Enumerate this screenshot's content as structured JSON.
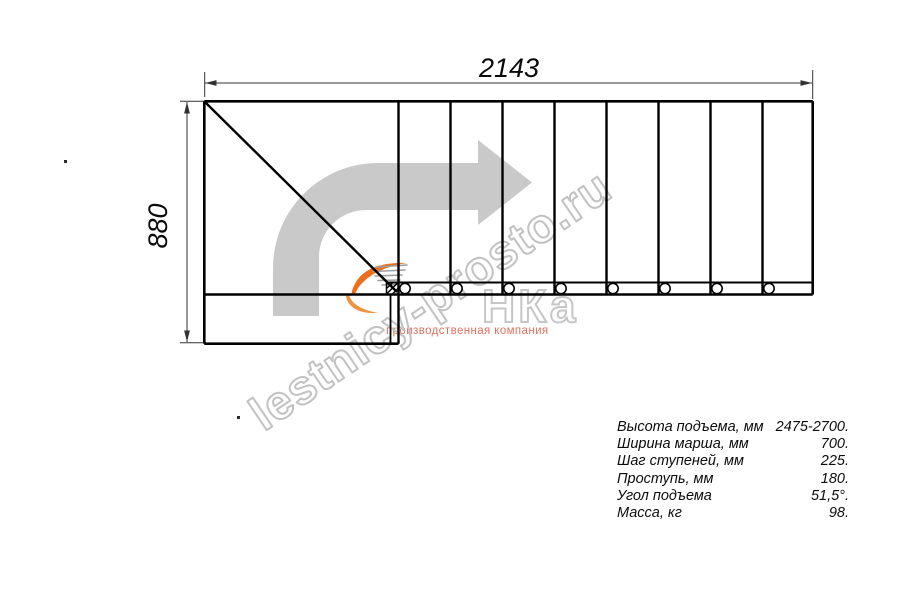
{
  "drawing": {
    "dim_top": "2143",
    "dim_left": "880",
    "type_label": "L-shaped staircase plan, 8 treads with bolt holes, turning platform with diagonal"
  },
  "specs": {
    "rows": [
      {
        "label": "Высота подъема, мм",
        "value": "2475-2700."
      },
      {
        "label": "Ширина марша, мм",
        "value": "700."
      },
      {
        "label": "Шаг ступеней, мм",
        "value": "225."
      },
      {
        "label": "Проступь, мм",
        "value": "180."
      },
      {
        "label": "Угол подъема",
        "value": "51,5°."
      },
      {
        "label": "Масса, кг",
        "value": "98."
      }
    ]
  },
  "watermark": {
    "site": "lestnicy-prosto.ru",
    "logo_text": "НКа",
    "tagline": "производственная компания"
  },
  "colors": {
    "line_black": "#000000",
    "dimension_gray": "#333333",
    "arrow_gray": "#c9c9c9",
    "watermark_outline": "#c2c2c2",
    "logo_orange": "#ed6f1d",
    "tagline_red": "#e2705e"
  }
}
